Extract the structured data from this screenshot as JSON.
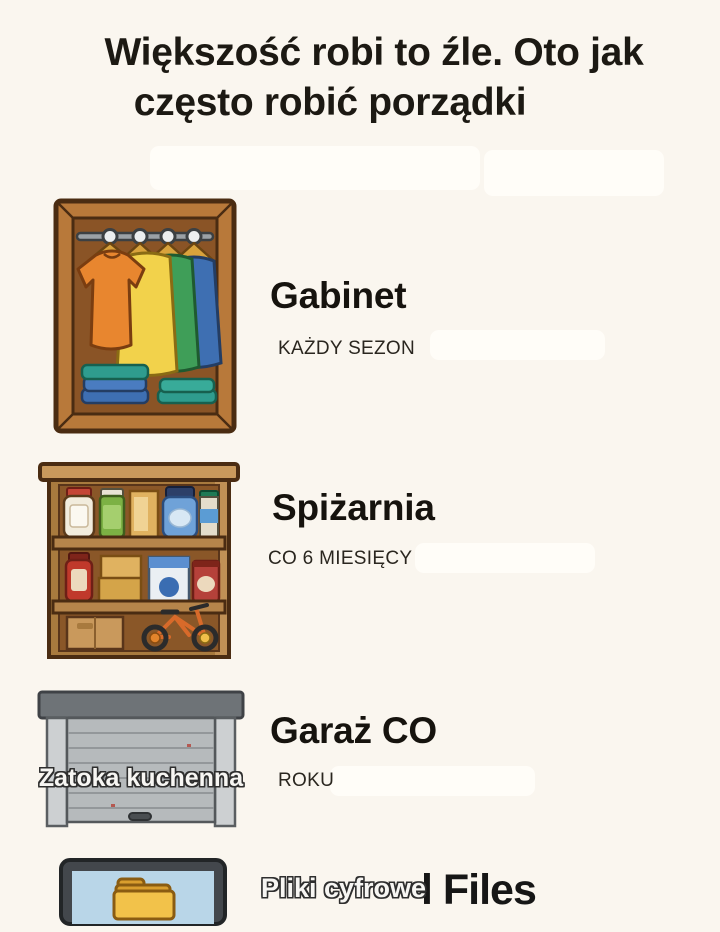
{
  "page": {
    "background_color": "#faf6ef",
    "title_line1": "Większość robi to źle. Oto jak",
    "title_line2": "często robić porządki",
    "text_color": "#1c1913"
  },
  "sections": [
    {
      "illustration": "wardrobe-closet-illustration",
      "heading": "Gabinet",
      "frequency": "KAŻDY SEZON"
    },
    {
      "illustration": "pantry-shelf-illustration",
      "heading": "Spiżarnia",
      "frequency": "CO 6 MIESIĘCY"
    },
    {
      "illustration": "garage-door-illustration",
      "heading": "Garaż CO",
      "frequency": "ROKU",
      "overlay_label": "Zatoka kuchenna"
    },
    {
      "illustration": "computer-monitor-folder-illustration",
      "overlay_label": "Pliki cyfrowe",
      "background_text": "l Files"
    }
  ]
}
